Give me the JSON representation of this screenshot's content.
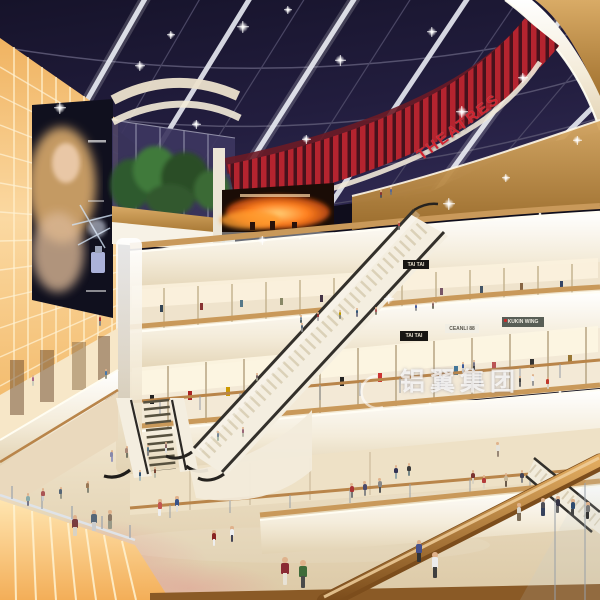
{
  "signs": {
    "theatres": "THEATRES",
    "tai_tai_upper": "TAI TAI",
    "tai_tai_lower": "TAI TAI",
    "store_white": "CEANLI 88",
    "store_red": "KUKIN WING"
  },
  "watermark": {
    "text": "铝翼集团"
  },
  "palette": {
    "sky": "#1d1933",
    "accent_red": "#b5242f",
    "cream": "#f1e8d6",
    "wood": "#bb8a47",
    "glow_wall": "#f9c97e",
    "floor": "#e9dcc2"
  },
  "people": [
    [
      285,
      585,
      28,
      "#8a2a33",
      "#e8e2d5"
    ],
    [
      303,
      588,
      28,
      "#3f6b3a",
      "#4a4a4a"
    ],
    [
      435,
      578,
      26,
      "#ececec",
      "#3f3f3f"
    ],
    [
      419,
      562,
      22,
      "#46518c",
      "#333333"
    ],
    [
      519,
      521,
      18,
      "#d9d5cc",
      "#7a6a55"
    ],
    [
      543,
      516,
      18,
      "#4f4f57",
      "#36425e"
    ],
    [
      558,
      513,
      17,
      "#333344",
      "#666666"
    ],
    [
      573,
      516,
      17,
      "#2e4a6e",
      "#444444"
    ],
    [
      588,
      519,
      17,
      "#777777",
      "#333333"
    ],
    [
      75,
      536,
      21,
      "#7a3d3f",
      "#d8d2c4"
    ],
    [
      94,
      531,
      21,
      "#556677",
      "#cccccc"
    ],
    [
      110,
      529,
      19,
      "#887766",
      "#999988"
    ],
    [
      160,
      516,
      17,
      "#c2554f",
      "#eeeeee"
    ],
    [
      177,
      512,
      16,
      "#37538a",
      "#dddddd"
    ],
    [
      352,
      498,
      15,
      "#aa3333",
      "#777777"
    ],
    [
      365,
      496,
      15,
      "#4a4a6a",
      "#888888"
    ],
    [
      380,
      493,
      15,
      "#888888",
      "#555555"
    ],
    [
      396,
      479,
      14,
      "#333355",
      "#99aaaa"
    ],
    [
      409,
      476,
      13,
      "#3b3b3b",
      "#778888"
    ],
    [
      214,
      546,
      16,
      "#882222",
      "#eeeeee"
    ],
    [
      232,
      542,
      16,
      "#eeeeee",
      "#444455"
    ],
    [
      498,
      457,
      15,
      "#e6e3da",
      "#998877"
    ],
    [
      473,
      484,
      14,
      "#7b3330",
      "#d9d2c2"
    ],
    [
      484,
      489,
      14,
      "#b33a3a",
      "#ded6c6"
    ],
    [
      506,
      487,
      14,
      "#c8b89a",
      "#6b5b4b"
    ],
    [
      522,
      483,
      13,
      "#444455",
      "#888888"
    ],
    [
      533,
      386,
      12,
      "#eeeeee",
      "#999999"
    ],
    [
      548,
      389,
      12,
      "#c0392b",
      "#d8cfc0"
    ],
    [
      520,
      387,
      11,
      "#444444",
      "#666666"
    ],
    [
      463,
      373,
      11,
      "#3b5998",
      "#cccccc"
    ],
    [
      474,
      371,
      11,
      "#777788",
      "#444444"
    ],
    [
      28,
      506,
      13,
      "#88aaaa",
      "#777788"
    ],
    [
      43,
      501,
      13,
      "#aa5555",
      "#cccccc"
    ],
    [
      61,
      499,
      12,
      "#556677",
      "#999988"
    ],
    [
      88,
      493,
      12,
      "#997755",
      "#888877"
    ],
    [
      112,
      462,
      12,
      "#8888aa",
      "#9999bb"
    ],
    [
      127,
      458,
      12,
      "#aa8877",
      "#777766"
    ],
    [
      148,
      456,
      11,
      "#557788",
      "#888888"
    ],
    [
      166,
      453,
      11,
      "#886666",
      "#dddddd"
    ],
    [
      218,
      441,
      10,
      "#778899",
      "#aabbaa"
    ],
    [
      243,
      437,
      10,
      "#996677",
      "#bbbbaa"
    ],
    [
      140,
      481,
      11,
      "#335577",
      "#aabbbb"
    ],
    [
      155,
      478,
      11,
      "#774433",
      "#bbbbaa"
    ],
    [
      318,
      321,
      9,
      "#993333",
      "#aaaaaa"
    ],
    [
      340,
      319,
      9,
      "#bb9900",
      "#888877"
    ],
    [
      357,
      317,
      9,
      "#335577",
      "#777788"
    ],
    [
      301,
      323,
      8,
      "#778899",
      "#556666"
    ],
    [
      376,
      315,
      8,
      "#aa5555",
      "#888877"
    ],
    [
      416,
      311,
      8,
      "#44589a",
      "#999999"
    ],
    [
      433,
      309,
      8,
      "#886666",
      "#777766"
    ],
    [
      381,
      198,
      8,
      "#883333",
      "#555555"
    ],
    [
      391,
      195,
      8,
      "#556699",
      "#777777"
    ],
    [
      399,
      230,
      9,
      "#bb4444",
      "#666666"
    ],
    [
      302,
      332,
      9,
      "#556677",
      "#888888"
    ],
    [
      257,
      381,
      8,
      "#776666",
      "#999988"
    ],
    [
      100,
      326,
      11,
      "#aa3333",
      "#888888"
    ],
    [
      33,
      386,
      11,
      "#aa6688",
      "#ccccbb"
    ],
    [
      106,
      379,
      10,
      "#4477aa",
      "#999988"
    ]
  ],
  "sparkles": [
    [
      60,
      108,
      12
    ],
    [
      140,
      66,
      10
    ],
    [
      243,
      27,
      12
    ],
    [
      196,
      124,
      9
    ],
    [
      340,
      60,
      11
    ],
    [
      306,
      139,
      9
    ],
    [
      432,
      32,
      10
    ],
    [
      462,
      112,
      12
    ],
    [
      523,
      78,
      10
    ],
    [
      577,
      140,
      9
    ],
    [
      449,
      204,
      12
    ],
    [
      262,
      240,
      9
    ],
    [
      389,
      299,
      10
    ],
    [
      288,
      10,
      8
    ],
    [
      506,
      178,
      8
    ],
    [
      171,
      35,
      8
    ]
  ]
}
